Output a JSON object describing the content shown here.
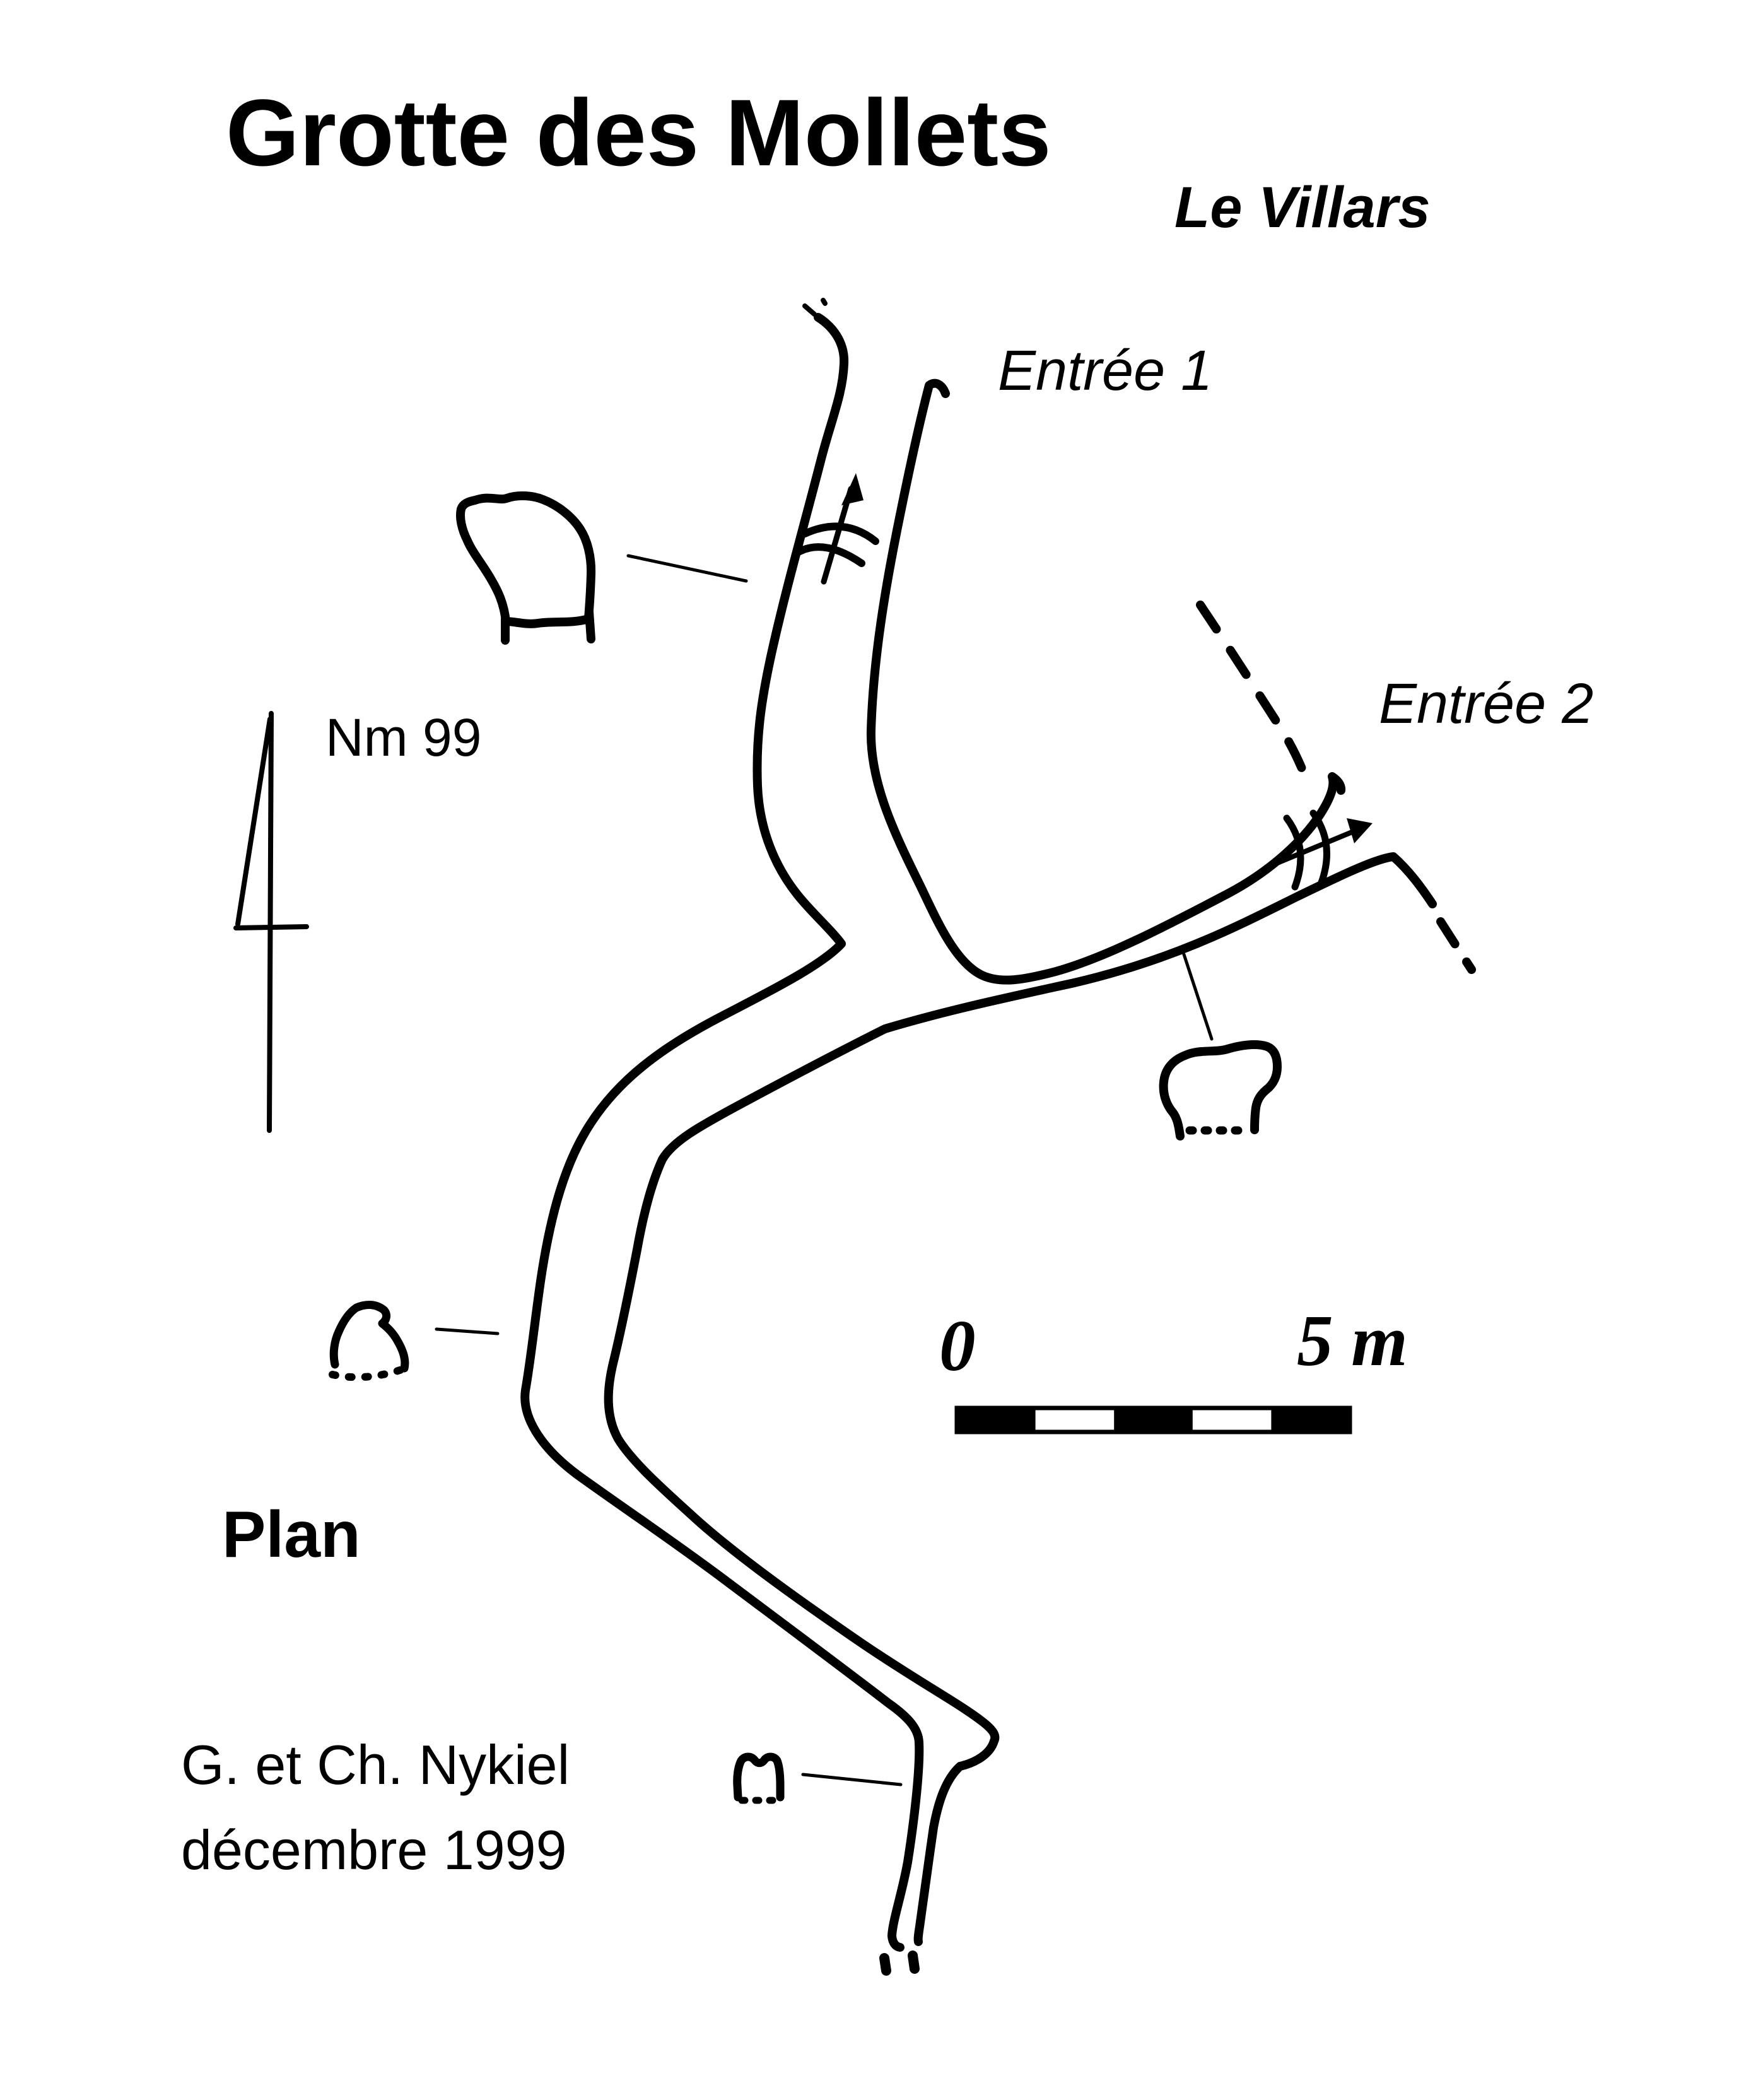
{
  "title": "Grotte des Mollets",
  "subtitle": "Le Villars",
  "labels": {
    "entrance1": "Entrée 1",
    "entrance2": "Entrée 2",
    "north_ref": "Nm 99",
    "view_type": "Plan"
  },
  "credits": {
    "authors": "G. et Ch. Nykiel",
    "date": "décembre 1999"
  },
  "scale_bar": {
    "start_label": "0",
    "end_label": "5 m"
  },
  "colors": {
    "ink": "#000000",
    "paper": "#ffffff"
  },
  "symbols": {
    "north": "north-arrow",
    "flow": "water-flow-arrow",
    "slope": "dashed-slope-line",
    "sections": "passage-cross-section",
    "scale": "alternating-bar-scale"
  }
}
